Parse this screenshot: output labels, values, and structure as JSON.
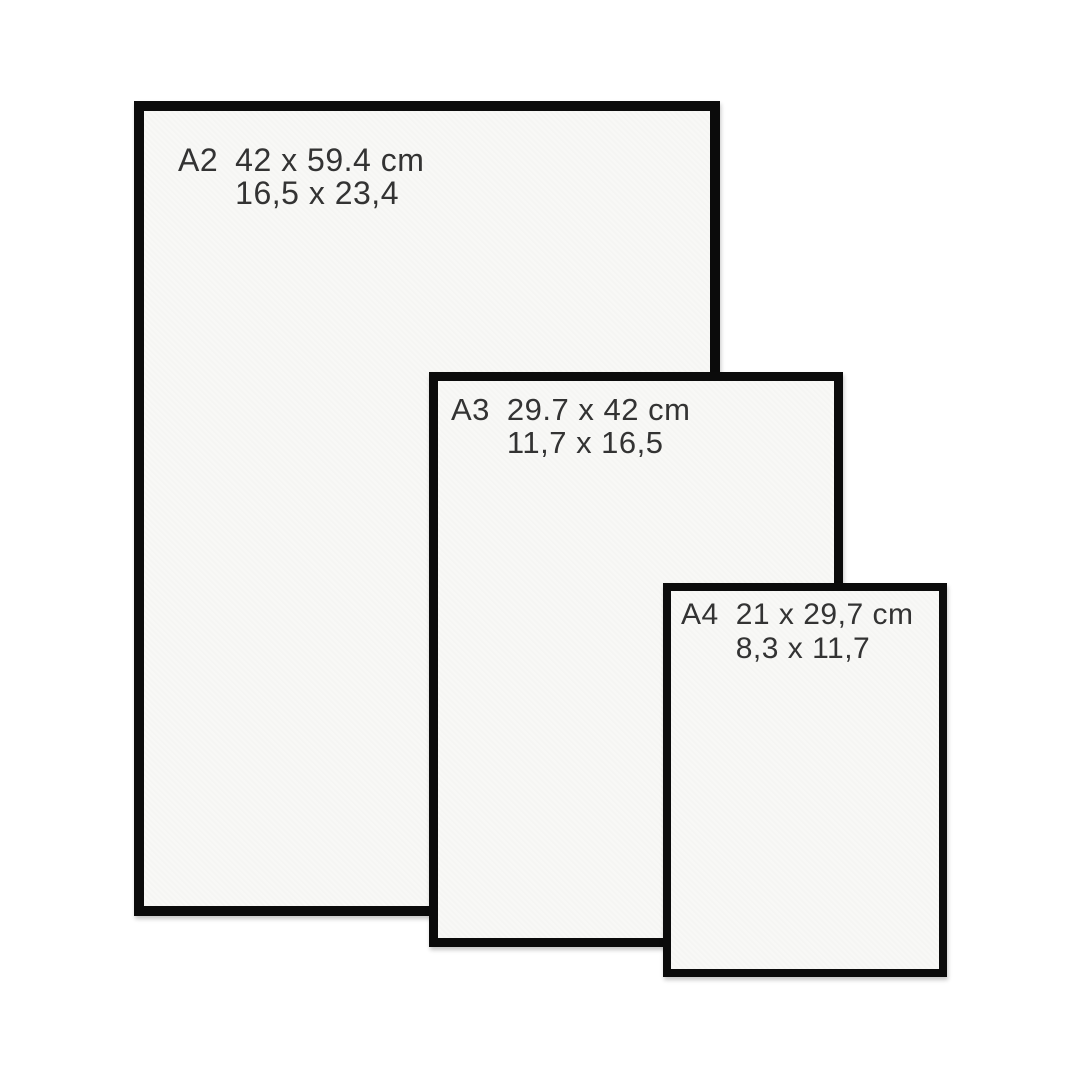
{
  "page": {
    "background": "#ffffff",
    "description": "Paper size comparison of framed prints"
  },
  "colors": {
    "frame_border": "#0b0b0b",
    "frame_fill": "#f8f8f6",
    "label_text": "#333333"
  },
  "frames": [
    {
      "code": "A2",
      "metric_size": "42 x 59.4 cm",
      "inch_size": "16,5 x 23,4"
    },
    {
      "code": "A3",
      "metric_size": "29.7 x 42 cm",
      "inch_size": "11,7 x 16,5"
    },
    {
      "code": "A4",
      "metric_size": "21 x 29,7 cm",
      "inch_size": "8,3 x 11,7"
    }
  ]
}
